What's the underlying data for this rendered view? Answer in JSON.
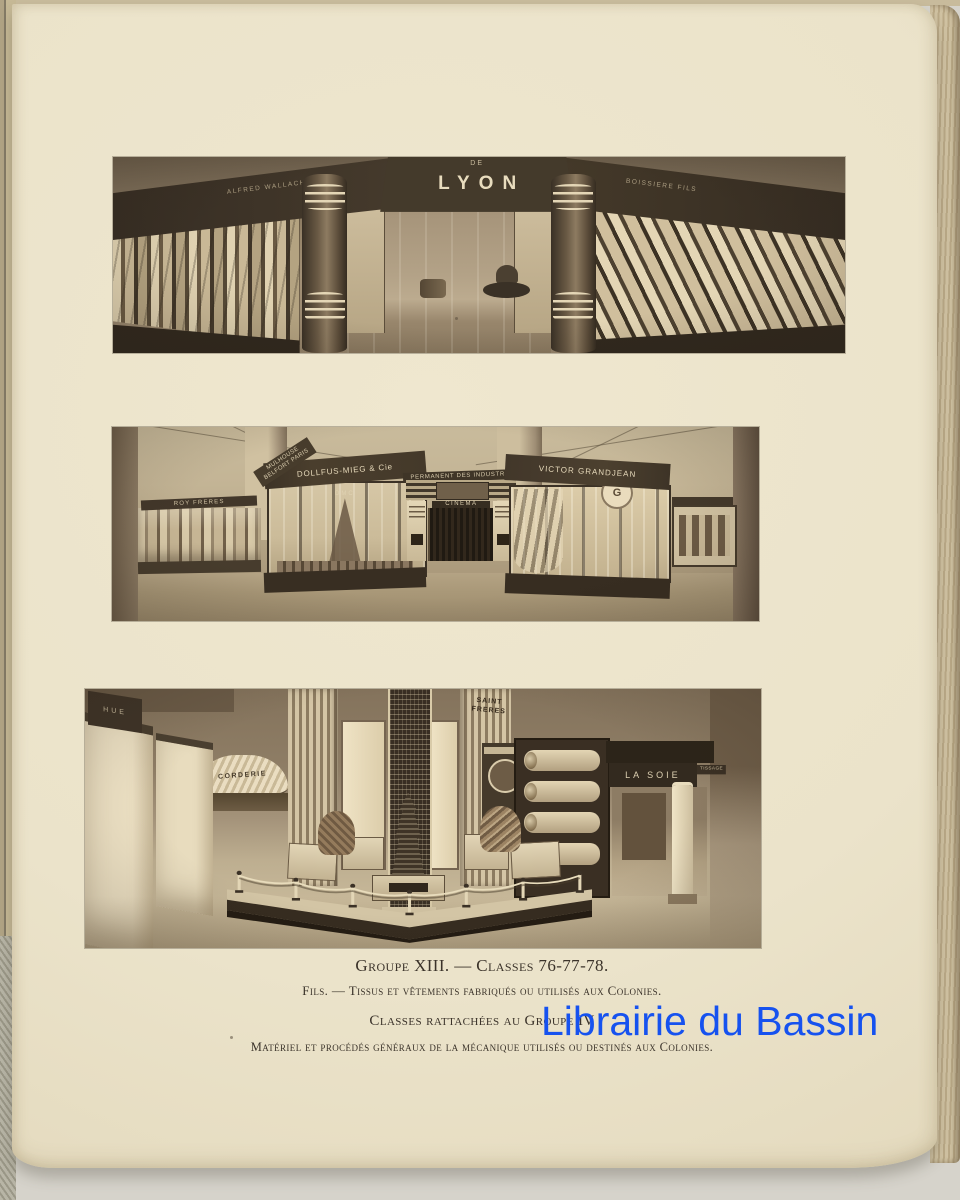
{
  "page": {
    "captions": {
      "line1": "Groupe XIII. — Classes 76-77-78.",
      "line2": "Fils. — Tissus et vêtements fabriqués ou utilisés aux Colonies.",
      "line3": "Classes rattachées au Groupe IV",
      "line4": "Matériel et procédés généraux de la mécanique utilisés ou destinés aux Colonies."
    },
    "watermark": {
      "text": "Librairie du Bassin",
      "color": "#1652ef"
    }
  },
  "photo_lyon": {
    "sign_de": "DE",
    "sign_lyon": "LYON",
    "sign_left": "ALFRED WALLACH",
    "sign_right": "BOISSIERE FILS"
  },
  "photo_hall": {
    "sign_mulhouse": "MULHOUSE BELFORT PARIS",
    "sign_roy": "ROY FRERES",
    "sign_dollfus": "DOLLFUS-MIEG & Cie",
    "sign_dmc": "DMC",
    "sign_permanent": "PERMANENT DES INDUSTRIE",
    "sign_cinema": "CINEMA",
    "sign_grandjean": "VICTOR GRANDJEAN",
    "sign_monogram": "G"
  },
  "photo_textiles": {
    "sign_hue": "HUE",
    "sign_corderie": "CORDERIE",
    "sign_saint": "SAINT FRERES",
    "sign_lasoie": "LA SOIE",
    "sign_tissage": "TISSAGE"
  }
}
